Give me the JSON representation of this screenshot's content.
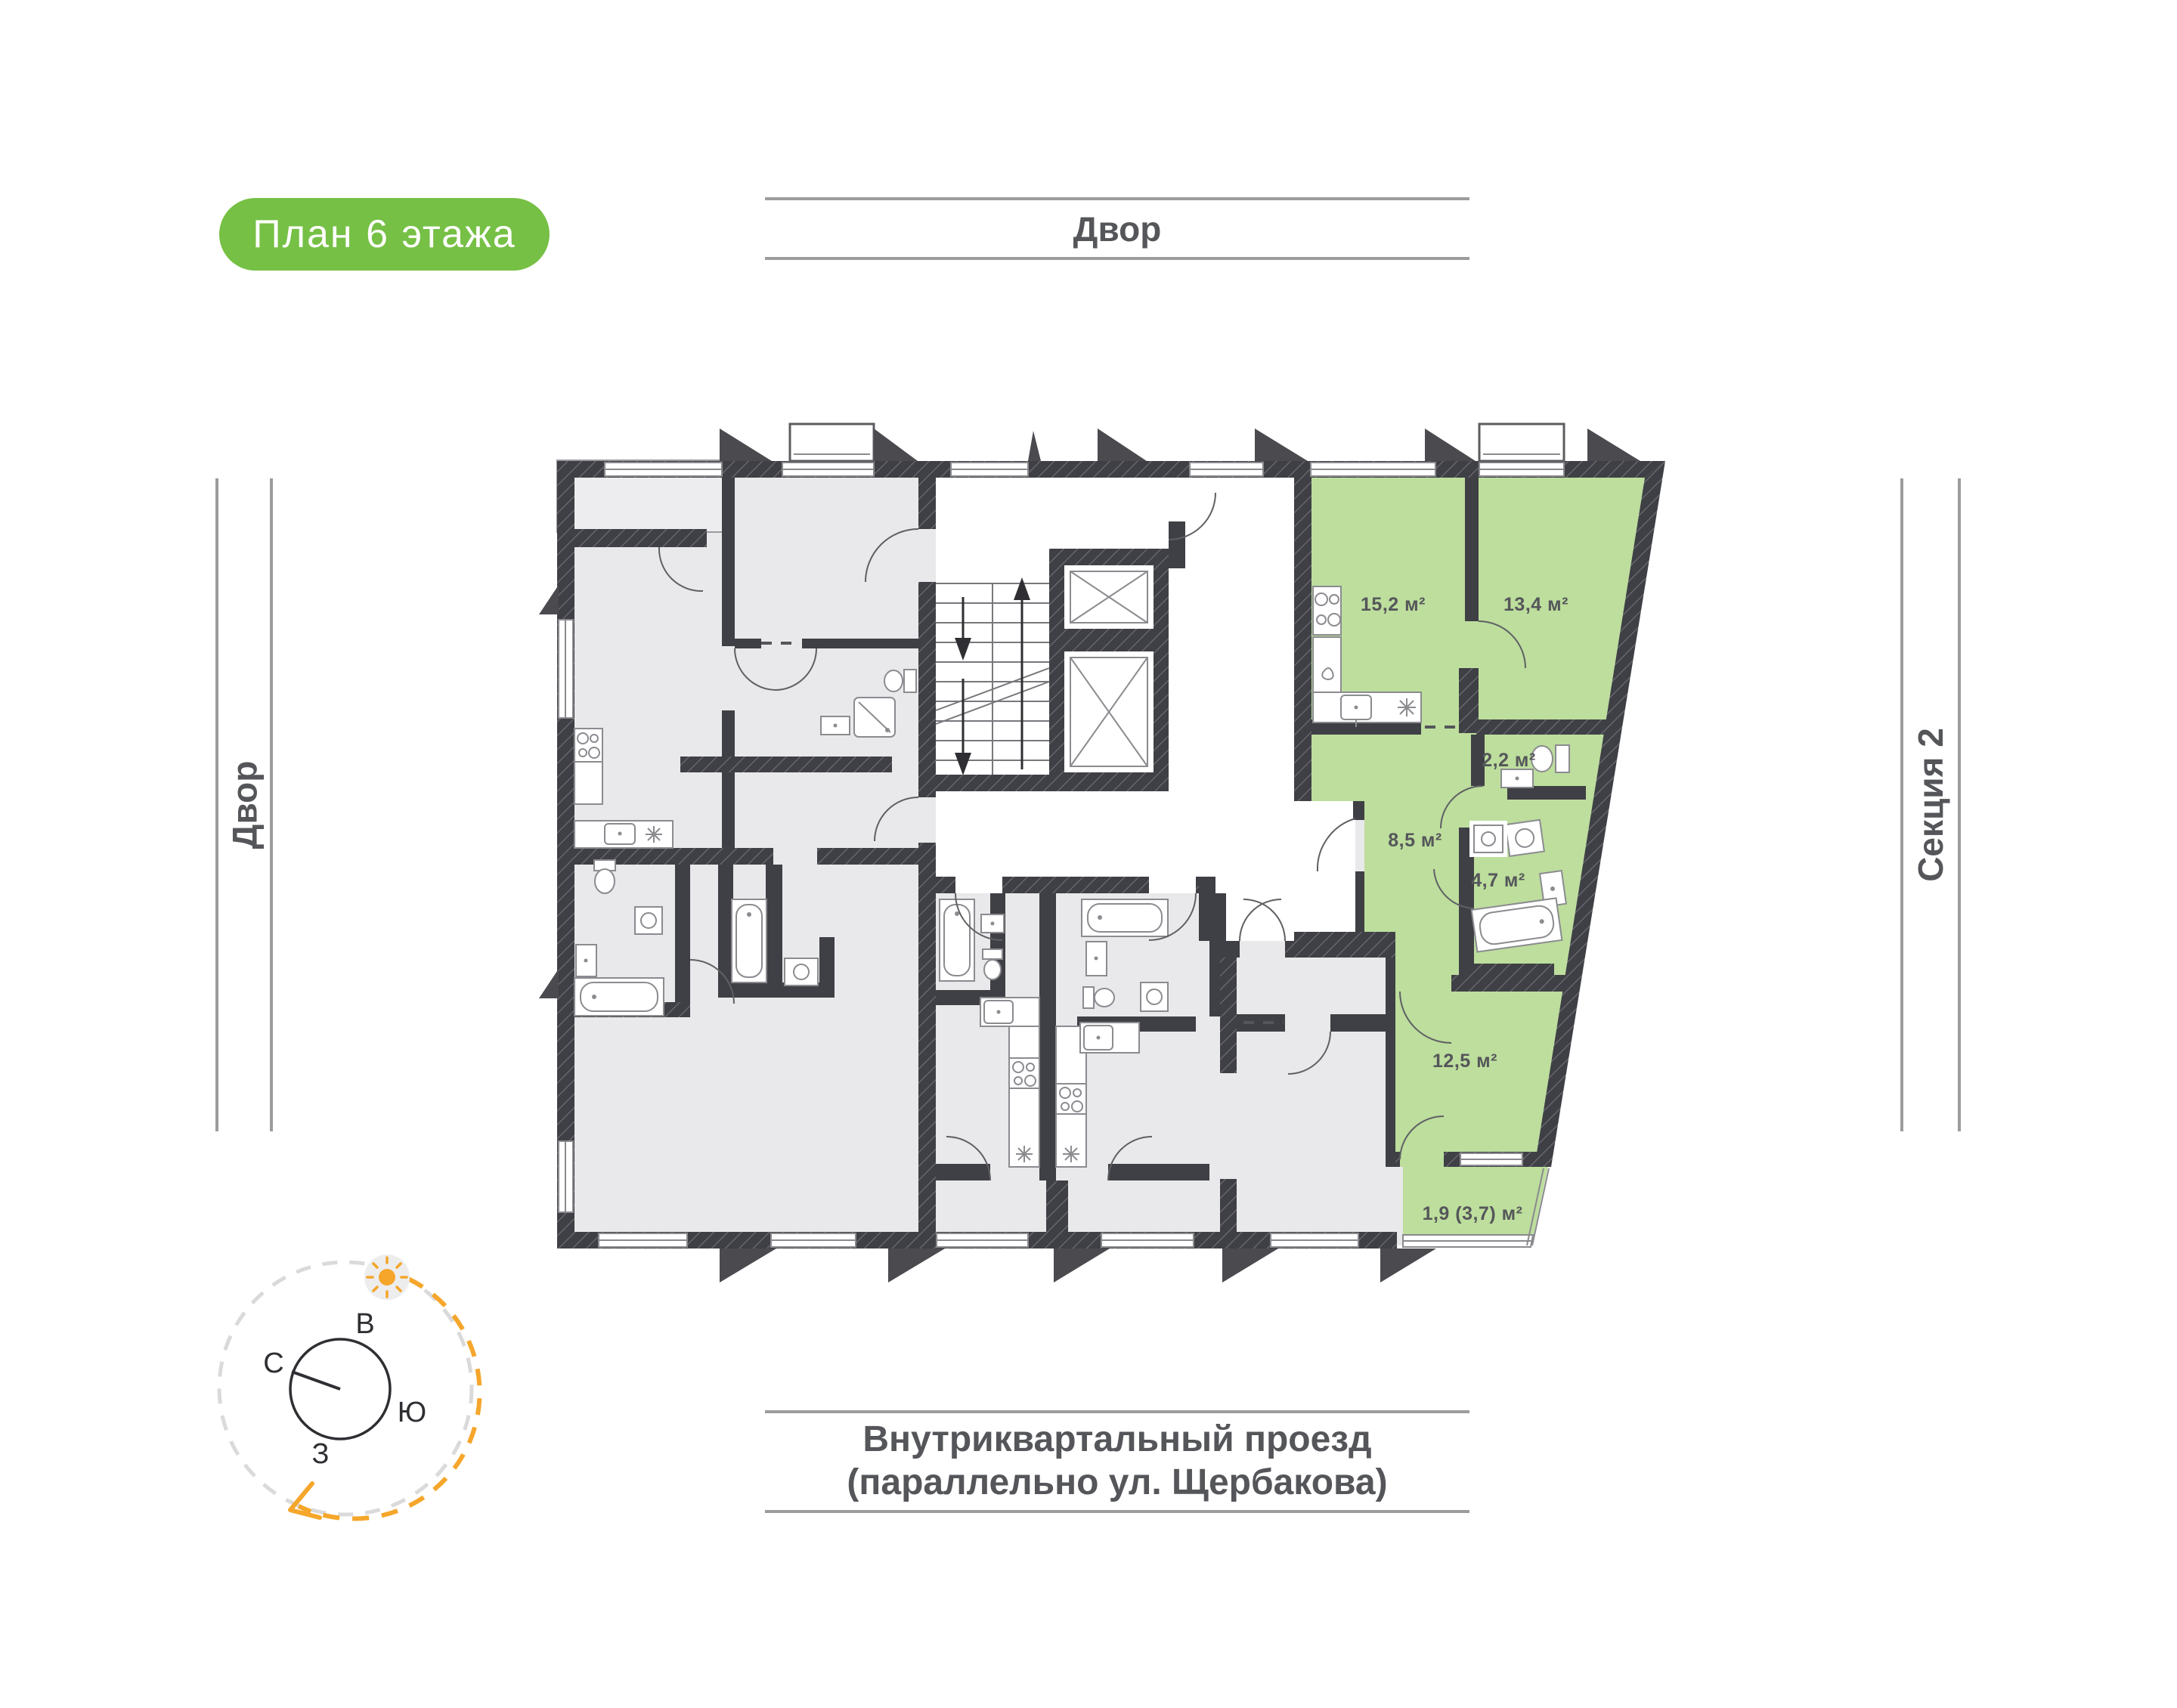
{
  "page": {
    "badge_label": "План 6 этажа",
    "floor_number": "6"
  },
  "surroundings": {
    "yard_top": "Двор",
    "yard_left": "Двор",
    "section_right": "Секция 2",
    "street_line1": "Внутриквартальный проезд",
    "street_line2": "(параллельно ул. Щербакова)"
  },
  "compass": {
    "north": "С",
    "east": "В",
    "south": "Ю",
    "west": "З"
  },
  "apartment": {
    "highlighted": true,
    "rooms": [
      {
        "name": "kitchen-living-room",
        "area": "15,2 м²"
      },
      {
        "name": "bedroom",
        "area": "13,4 м²"
      },
      {
        "name": "water-closet",
        "area": "2,2 м²"
      },
      {
        "name": "hallway",
        "area": "8,5 м²"
      },
      {
        "name": "bathroom",
        "area": "4,7 м²"
      },
      {
        "name": "bedroom-2",
        "area": "12,5 м²"
      },
      {
        "name": "balcony",
        "area": "1,9 (3,7) м²"
      }
    ]
  },
  "plan_icons": [
    "stairs-icon",
    "elevator-icon",
    "bathtub-icon",
    "toilet-icon",
    "sink-icon",
    "stove-icon",
    "washing-machine-icon",
    "shower-icon",
    "refrigerator-icon",
    "sun-icon",
    "compass-icon"
  ],
  "colors": {
    "badge_green": "#76c045",
    "apartment_green": "#bdde9d",
    "wall_dark": "#3f4045",
    "room_gray": "#e9e9eb",
    "text_gray": "#55565a",
    "road_line_gray": "#9c9c9c",
    "accent_orange": "#f5a62b"
  }
}
